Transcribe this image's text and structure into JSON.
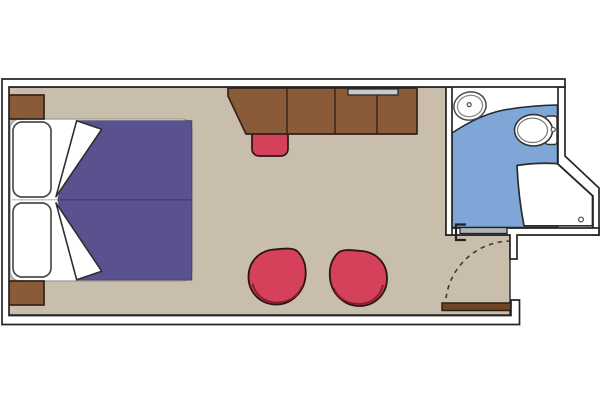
{
  "canvas": {
    "width": 600,
    "height": 400
  },
  "colors": {
    "background": "#ffffff",
    "wall_line": "#252525",
    "floor": "#c9beac",
    "bathroom_floor": "#7ea7d8",
    "wood": "#8a5b39",
    "wood_stroke": "#33221a",
    "wood_dark": "#6f4526",
    "duvet": "#5a528e",
    "duvet_seam": "#443c75",
    "red": "#d5415a",
    "red_stroke": "#2b1416",
    "red_rim": "#7f1d2b",
    "tv_gray": "#c7cbd0",
    "bath_door_gray": "#aeb4b8",
    "fixture_stroke": "#3a3a3a",
    "pillow_stroke": "#4d4d4d",
    "mattress_stroke": "#9a9a9a",
    "arc_dash": "#3a3a3a",
    "white": "#ffffff"
  },
  "plan": {
    "rooms": [
      {
        "id": "cabin",
        "floor_color_ref": "floor"
      },
      {
        "id": "bathroom",
        "floor_color_ref": "bathroom_floor"
      }
    ],
    "cabin_elements": [
      "double-bed",
      "pillow",
      "pillow",
      "duvet",
      "nightstand",
      "nightstand",
      "desk",
      "wardrobe-cabinet",
      "tv",
      "stool",
      "armchair",
      "armchair",
      "entry-door",
      "door-swing-arc"
    ],
    "bathroom_elements": [
      "sink",
      "toilet",
      "shower",
      "shower-drain",
      "sliding-door",
      "door-track-bracket"
    ],
    "counts": {
      "armchairs": 2,
      "pillows": 2,
      "nightstands": 2
    }
  }
}
